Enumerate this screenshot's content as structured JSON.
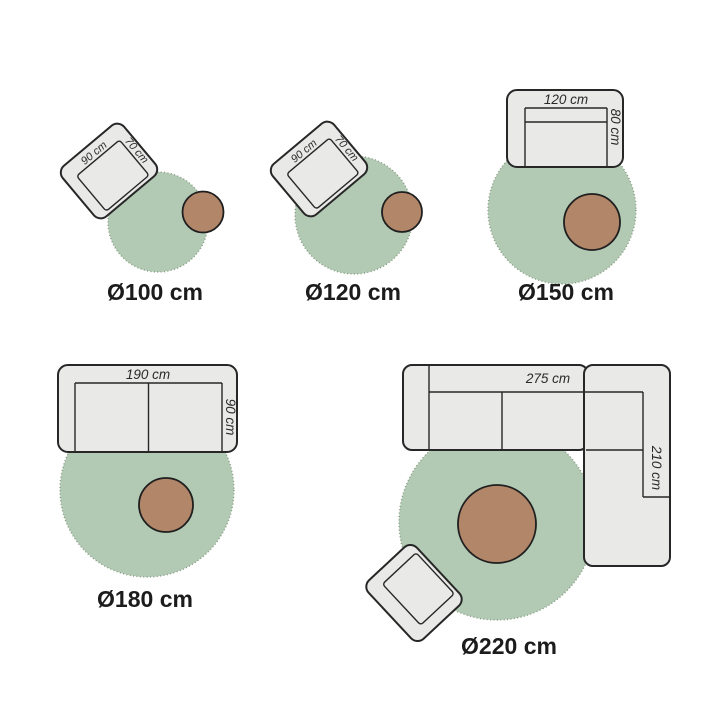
{
  "title": "rug-size-guide",
  "colors": {
    "background": "#ffffff",
    "rug_fill": "#b2c9b4",
    "rug_dotted_edge": "#85997f",
    "furniture_fill": "#e9e9e8",
    "outline": "#272727",
    "side_table_fill": "#b28669",
    "label_text": "#1c1c1c"
  },
  "diagrams": [
    {
      "name": "rug-100",
      "rug_label": "Ø100 cm",
      "furniture": {
        "type": "armchair",
        "width_label": "90 cm",
        "depth_label": "70 cm"
      },
      "extras": [
        "side-table"
      ]
    },
    {
      "name": "rug-120",
      "rug_label": "Ø120 cm",
      "furniture": {
        "type": "armchair",
        "width_label": "90 cm",
        "depth_label": "70 cm"
      },
      "extras": [
        "side-table"
      ]
    },
    {
      "name": "rug-150",
      "rug_label": "Ø150 cm",
      "furniture": {
        "type": "two-seat-sofa",
        "width_label": "120 cm",
        "depth_label": "80 cm"
      },
      "extras": [
        "side-table"
      ]
    },
    {
      "name": "rug-180",
      "rug_label": "Ø180 cm",
      "furniture": {
        "type": "two-seat-sofa",
        "width_label": "190 cm",
        "depth_label": "90 cm"
      },
      "extras": [
        "side-table"
      ]
    },
    {
      "name": "rug-220",
      "rug_label": "Ø220 cm",
      "furniture": {
        "type": "corner-sofa",
        "width_label": "275 cm",
        "depth_label": "210 cm"
      },
      "extras": [
        "side-table",
        "armchair"
      ]
    }
  ]
}
